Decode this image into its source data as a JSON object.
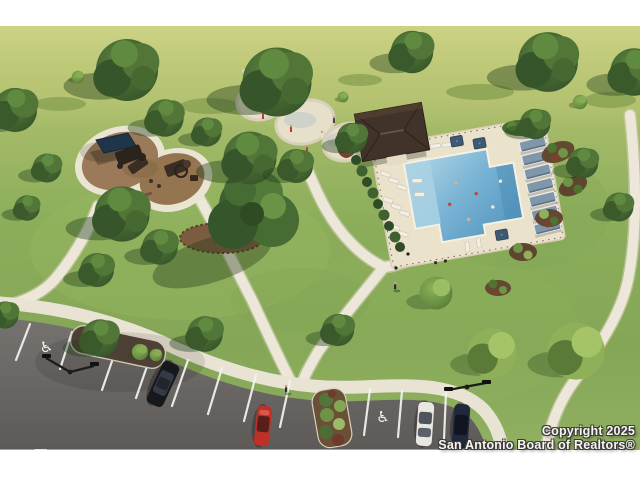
{
  "watermark": {
    "line1": "Copyright 2025",
    "line2": "San Antonio Board of Realtors®"
  },
  "scene": {
    "type": "aerial-3d-rendering",
    "subject": "community amenity center park",
    "amenities": [
      "swimming pool with tanning ledge",
      "cabana row",
      "lounge chairs",
      "shade umbrellas",
      "pool pavilion",
      "splash pad",
      "playground with shade canopy",
      "walking trails",
      "parking lot with accessible stalls",
      "landscape beds",
      "central oak tree"
    ],
    "cars": [
      "black",
      "red",
      "white",
      "navy"
    ],
    "people_visible": true,
    "palette": {
      "grass_light": "#c8ce81",
      "grass_mid": "#8cae5b",
      "path": "#ece7d8",
      "asphalt": "#6e6a68",
      "pool_water": "#5f9fc6",
      "pool_deck": "#ebe2cc",
      "cabana_blue": "#8097ab",
      "umbrella_navy": "#3e5a74",
      "playground_mulch": "#9a7a58",
      "canopy_navy": "#1f3549",
      "pavilion_roof": "#42332a",
      "mulch_bed": "#634832",
      "stripe_white": "#f4f4f0"
    }
  }
}
